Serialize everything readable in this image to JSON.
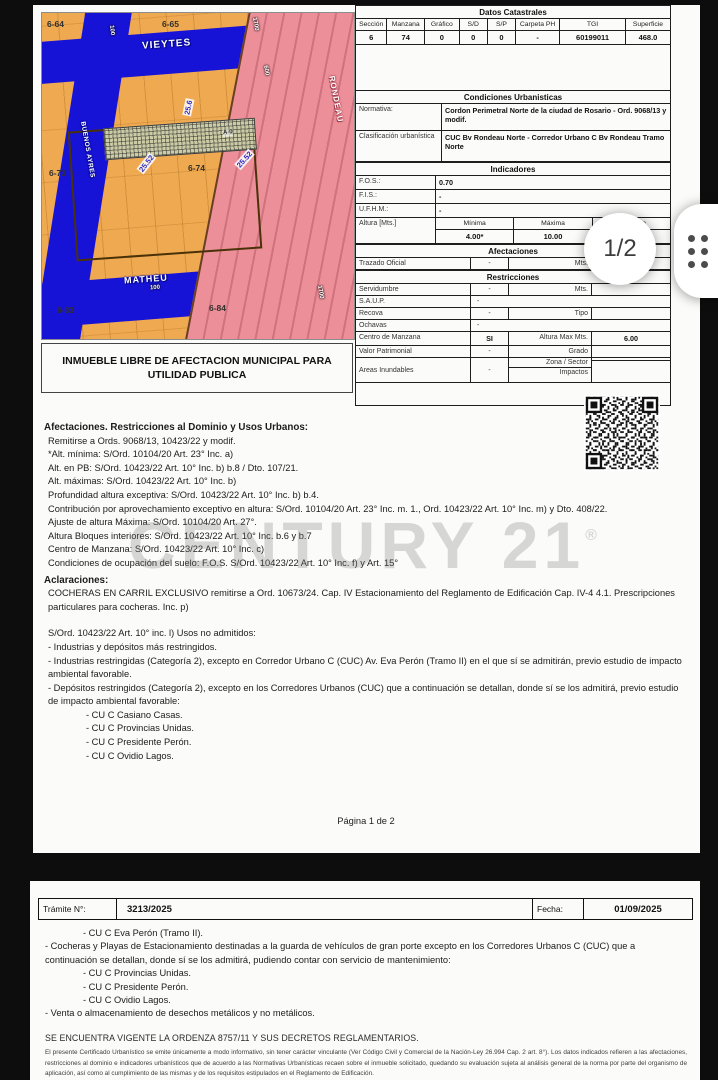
{
  "viewer": {
    "page_indicator": "1/2"
  },
  "watermark": {
    "text": "CENTURY 21",
    "reg": "®"
  },
  "map": {
    "street_top": "VIEYTES",
    "street_bottom": "MATHEU",
    "street_left": "BUENOS AYRES",
    "street_diagonal": "RONDEAU",
    "blocks": {
      "b64": "6-64",
      "b65": "6-65",
      "b73": "6-73",
      "b74": "6-74",
      "b83": "6-83",
      "b84": "6-84"
    },
    "dims": {
      "left": "25.52",
      "right": "25.52",
      "top": "25.6"
    },
    "parcel": "A-0",
    "chips": {
      "pink_top": "1700",
      "pink_mid": "600",
      "pink_bottom": "1700",
      "matheu": "100",
      "left_street": "100"
    },
    "note": "INMUEBLE LIBRE DE AFECTACION MUNICIPAL PARA UTILIDAD PUBLICA"
  },
  "datos": {
    "title": "Datos Catastrales",
    "headers": [
      "Sección",
      "Manzana",
      "Gráfico",
      "S/D",
      "S/P",
      "Carpeta PH",
      "TGI",
      "Superficie"
    ],
    "values": [
      "6",
      "74",
      "0",
      "0",
      "0",
      "-",
      "60199011",
      "468.0"
    ]
  },
  "condiciones": {
    "title": "Condiciones Urbanisticas",
    "normativa_label": "Normativa:",
    "normativa": "Cordon Perimetral Norte de la ciudad de Rosario - Ord. 9068/13 y modif.",
    "clasif_label": "Clasificación urbanística",
    "clasif": "CUC Bv Rondeau Norte - Corredor Urbano C Bv Rondeau Tramo Norte"
  },
  "indicadores": {
    "title": "Indicadores",
    "fos_label": "F.O.S.:",
    "fos": "0.70",
    "fis_label": "F.I.S.:",
    "fis": "-",
    "ufhm_label": "U.F.H.M.:",
    "ufhm": "-",
    "altura_label": "Altura [Mts.]",
    "altura_headers": [
      "Mínima",
      "Máxima",
      "Exceptiva"
    ],
    "altura_values": [
      "4.00*",
      "10.00",
      "- 6)"
    ]
  },
  "afectaciones": {
    "title": "Afectaciones",
    "trazado_label": "Trazado Oficial",
    "trazado_value": "-",
    "trazado_unit": "Mts."
  },
  "restricciones": {
    "title": "Restricciones",
    "servidumbre_label": "Servidumbre",
    "servidumbre_value": "-",
    "servidumbre_unit": "Mts.",
    "saup_label": "S.A.U.P.",
    "saup_value": "-",
    "recova_label": "Recova",
    "recova_value": "-",
    "recova_unit": "Tipo",
    "ochavas_label": "Ochavas",
    "ochavas_value": "-",
    "centro_label": "Centro de Manzana",
    "centro_value": "SI",
    "centro_unit": "Altura Max Mts.",
    "centro_extra": "6.00",
    "valor_label": "Valor Patrimonial",
    "valor_value": "-",
    "valor_unit": "Grado",
    "areas_label": "Areas Inundables",
    "areas_value": "-",
    "areas_unit1": "Zona / Sector",
    "areas_unit2": "Impactos"
  },
  "body": {
    "heading": "Afectaciones. Restricciones al Dominio y Usos Urbanos:",
    "lines": [
      "Remitirse a Ords. 9068/13, 10423/22 y modif.",
      "*Alt. mínima: S/Ord. 10104/20 Art. 23° Inc. a)",
      "Alt. en PB: S/Ord. 10423/22 Art. 10° Inc. b) b.8  / Dto. 107/21.",
      "Alt. máximas: S/Ord. 10423/22 Art. 10° Inc. b)",
      "Profundidad altura exceptiva: S/Ord. 10423/22 Art. 10° Inc. b) b.4.",
      "Contribución por aprovechamiento exceptivo en altura: S/Ord. 10104/20 Art. 23° Inc. m. 1., Ord. 10423/22 Art. 10° Inc. m) y Dto. 408/22.",
      "Ajuste de altura Máxima: S/Ord. 10104/20 Art. 27°.",
      "Altura Bloques interiores: S/Ord. 10423/22 Art. 10° Inc. b.6 y b.7",
      "Centro de Manzana: S/Ord. 10423/22 Art. 10° Inc. c)",
      "Condiciones de ocupación del suelo: F.O.S. S/Ord. 10423/22 Art. 10° Inc. f) y Art. 15°"
    ],
    "aclaraciones_heading": "Aclaraciones:",
    "aclaraciones": [
      "COCHERAS EN CARRIL EXCLUSIVO remitirse a Ord. 10673/24. Cap. IV Estacionamiento del Reglamento de Edificación Cap. IV-4 4.1. Prescripciones particulares para cocheras. Inc. p)",
      "S/Ord. 10423/22 Art. 10° inc. l) Usos no admitidos:",
      "- Industrias y depósitos más restringidos.",
      "- Industrias restringidas (Categoría 2), excepto en Corredor Urbano C (CUC) Av. Eva Perón (Tramo II) en el que sí se admitirán, previo estudio de impacto ambiental favorable.",
      "- Depósitos restringidos (Categoría 2), excepto en los Corredores Urbanos (CUC) que a continuación se detallan, donde sí se los admitirá, previo estudio de impacto ambiental favorable:",
      "- CU C Casiano Casas.",
      "- CU C Provincias Unidas.",
      "- CU C Presidente Perón.",
      "- CU C Ovidio Lagos."
    ],
    "footer": "Página 1 de  2"
  },
  "page2": {
    "tramite_label": "Trámite N°:",
    "tramite_value": "3213/2025",
    "fecha_label": "Fecha:",
    "fecha_value": "01/09/2025",
    "lines": [
      "- CU C Eva Perón (Tramo II).",
      "- Cocheras y Playas de Estacionamiento destinadas a la guarda de vehículos de gran porte excepto en los Corredores Urbanos C (CUC) que a continuación se detallan, donde sí se los admitirá, pudiendo contar con servicio de mantenimiento:",
      "- CU C Provincias Unidas.",
      "- CU C Presidente Perón.",
      "- CU C Ovidio Lagos.",
      "- Venta o almacenamiento de desechos metálicos y no metálicos."
    ],
    "vigente": "SE ENCUENTRA VIGENTE LA ORDENZA 8757/11 Y SUS DECRETOS REGLAMENTARIOS.",
    "fine_print": "El presente Certificado Urbanístico se emite únicamente a modo informativo, sin tener carácter vinculante (Ver Código Civil y Comercial de la Nación-Ley 26.994 Cap. 2 art. 8°). Los datos indicados refieren a las afectaciones, restricciones al dominio e indicadores urbanísticos que de acuerdo a las Normativas Urbanísticas recaen sobre el inmueble solicitado, quedando su evaluación sujeta al análisis general de la norma por parte del organismo de aplicación, así como al cumplimiento de las mismas y de los requisitos estipulados en el Reglamento de Edificación."
  }
}
